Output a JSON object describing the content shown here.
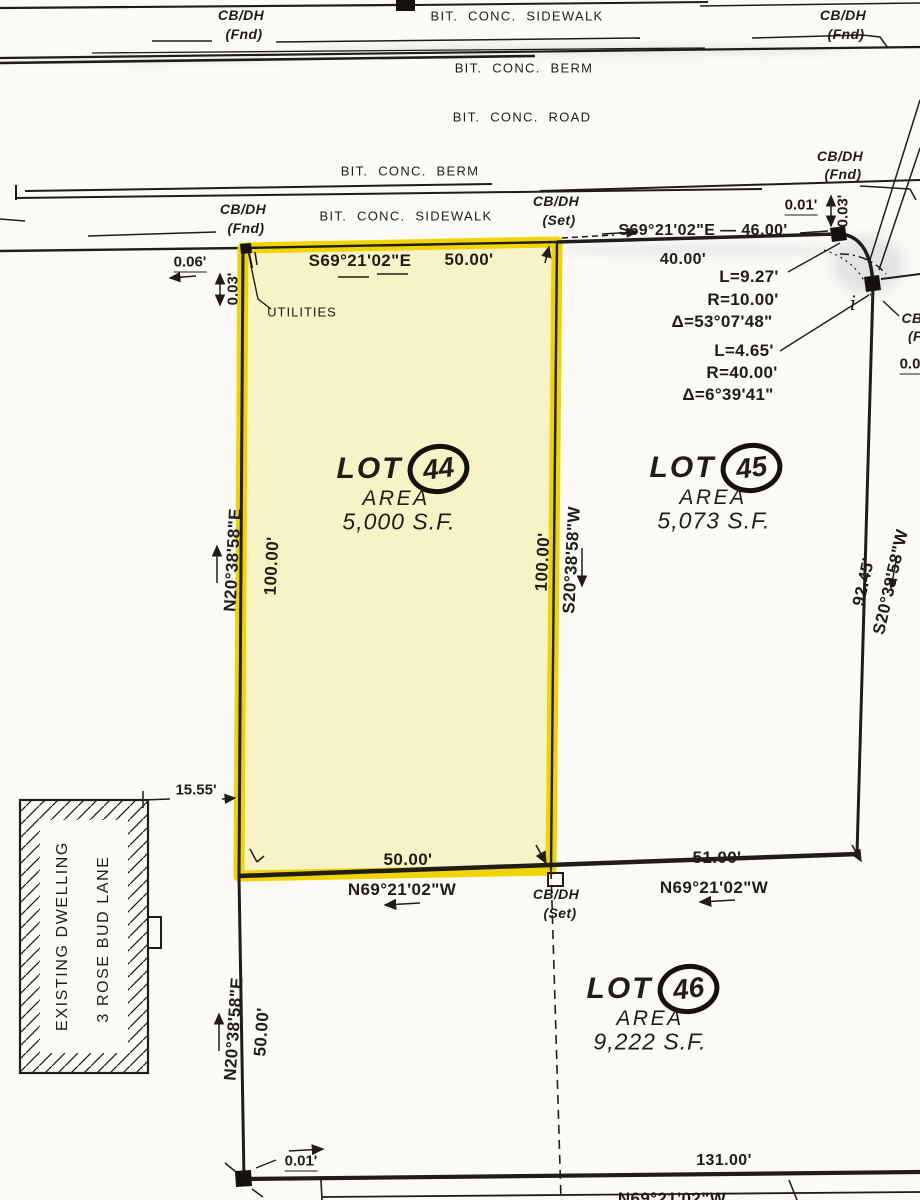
{
  "colors": {
    "paper": "#fbfaf6",
    "ink": "#201d19",
    "highlight_border": "#f0d402",
    "highlight_fill": "#f8f3c6"
  },
  "street_labels": {
    "sidewalk_top": "BIT. CONC. SIDEWALK",
    "berm_top": "BIT. CONC. BERM",
    "road": "BIT. CONC. ROAD",
    "berm_mid": "BIT. CONC. BERM",
    "sidewalk_mid": "BIT. CONC. SIDEWALK"
  },
  "monuments": {
    "cbdh": "CB/DH",
    "fnd": "(Fnd)",
    "set": "(Set)",
    "iron_pin": "i",
    "clipped_cb": "CB",
    "clipped_fnd": "(F",
    "clipped_dim": "0.0"
  },
  "annotations": {
    "utilities": "UTILITIES"
  },
  "bearings": {
    "n_line_45": "S69°21'02\"E — 46.00'",
    "seg_40": "40.00'",
    "top44_bearing": "S69°21'02\"E",
    "top44_dist": "50.00'",
    "left44_bearing": "N20°38'58\"E",
    "left44_dist": "100.00'",
    "right44_dist": "100.00'",
    "right44_bearing": "S20°38'58\"W",
    "right45_dist": "92.45'",
    "right45_bearing": "S20°38'58\"W",
    "bot44_dist": "50.00'",
    "bot44_bearing": "N69°21'02\"W",
    "bot45_dist": "51.00'",
    "bot45_bearing": "N69°21'02\"W",
    "left46_bearing": "N20°38'58\"E",
    "left46_dist": "50.00'",
    "bot46_dist": "131.00'",
    "bot46_bearing": "N69°21'02\"W"
  },
  "curve_data": {
    "c1_l": "L=9.27'",
    "c1_r": "R=10.00'",
    "c1_d": "Δ=53°07'48\"",
    "c2_l": "L=4.65'",
    "c2_r": "R=40.00'",
    "c2_d": "Δ=6°39'41\""
  },
  "offsets": {
    "top_001": "0.01'",
    "top_003": "0.03'",
    "left_006": "0.06'",
    "left_003": "0.03'",
    "dwelling_setback": "15.55'",
    "bot_001": "0.01'"
  },
  "lots": [
    {
      "label": "LOT",
      "number": "44",
      "area_label": "AREA",
      "area": "5,000  S.F."
    },
    {
      "label": "LOT",
      "number": "45",
      "area_label": "AREA",
      "area": "5,073  S.F."
    },
    {
      "label": "LOT",
      "number": "46",
      "area_label": "AREA",
      "area": "9,222  S.F."
    }
  ],
  "dwelling": {
    "line1": "EXISTING DWELLING",
    "line2": "3 ROSE BUD LANE"
  }
}
